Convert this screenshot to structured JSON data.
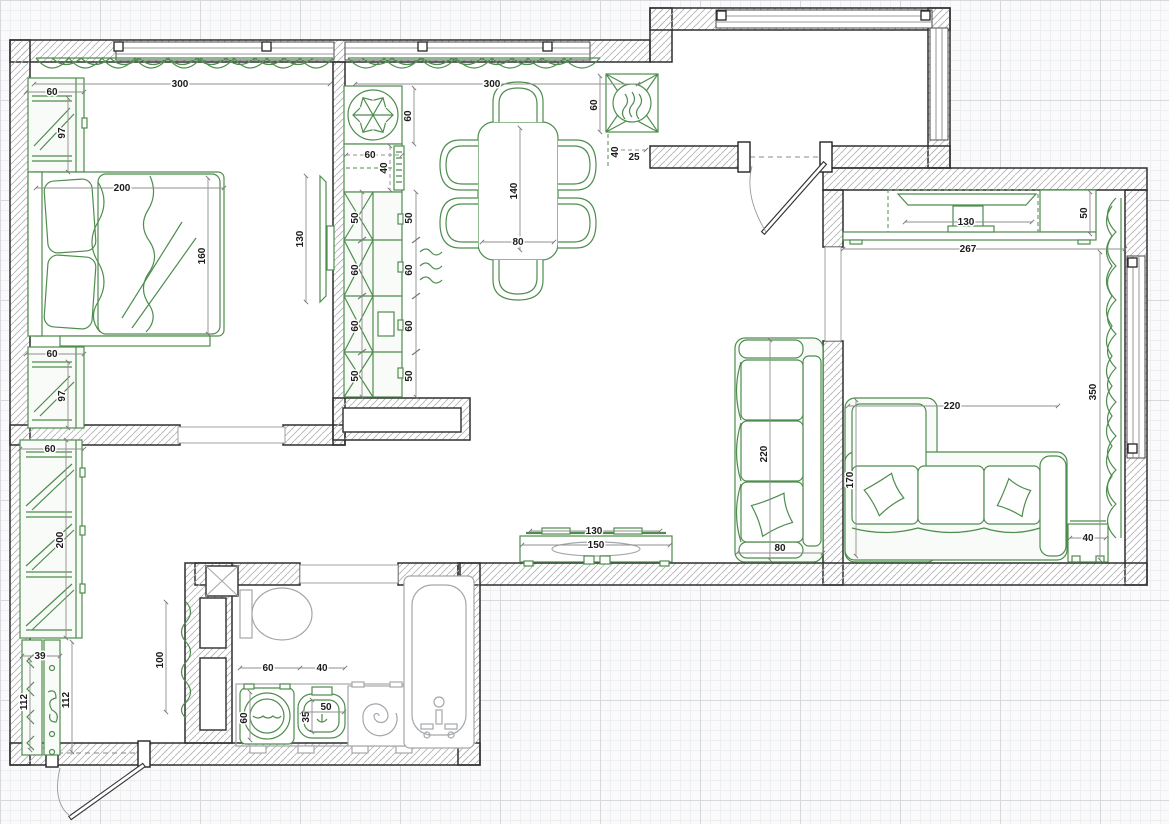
{
  "plan": {
    "colors": {
      "furniture": "#4e8d4e",
      "fixtures": "#a3a7ab",
      "walls": "#2e2e2e",
      "dimension_text": "#1c1c1c",
      "grid_minor": "#eceef2",
      "grid_major": "#d7d8dd"
    },
    "dims": {
      "bedroom": {
        "window_w": "300",
        "wardrobe_top_w": "60",
        "wardrobe_top_d": "97",
        "bed_w": "200",
        "bed_d": "160",
        "tv_w": "130",
        "wardrobe_bottom_w": "60",
        "wardrobe_bottom_d": "97"
      },
      "kitchen": {
        "window_w": "300",
        "fridge_w": "60",
        "sink_w": "60",
        "sink_d": "40",
        "cabinets_inner": [
          "50",
          "60",
          "60",
          "50"
        ],
        "cabinets_outer": [
          "50",
          "60",
          "60",
          "50"
        ],
        "table_l": "140",
        "table_w": "80",
        "stove_w": "60",
        "stove_offset_a": "40",
        "stove_offset_b": "25"
      },
      "living": {
        "tv_w": "130",
        "cabinet_d": "50",
        "room_w": "267",
        "room_d": "350",
        "sofa_w": "220",
        "sofa_d": "170",
        "side_table_w": "40"
      },
      "hall": {
        "sofa_l": "220",
        "sofa_d": "80",
        "tv_w": "130",
        "console_w": "150"
      },
      "hallway": {
        "wardrobe_w": "60",
        "wardrobe_l": "200",
        "rack_w": "39",
        "rack_l": "112",
        "clearance": "112",
        "radiator_l": "100"
      },
      "bathroom": {
        "washer_w": "60",
        "sink_offset": "40",
        "washer_d": "60",
        "sink_d": "35",
        "sink_w": "50"
      }
    }
  }
}
